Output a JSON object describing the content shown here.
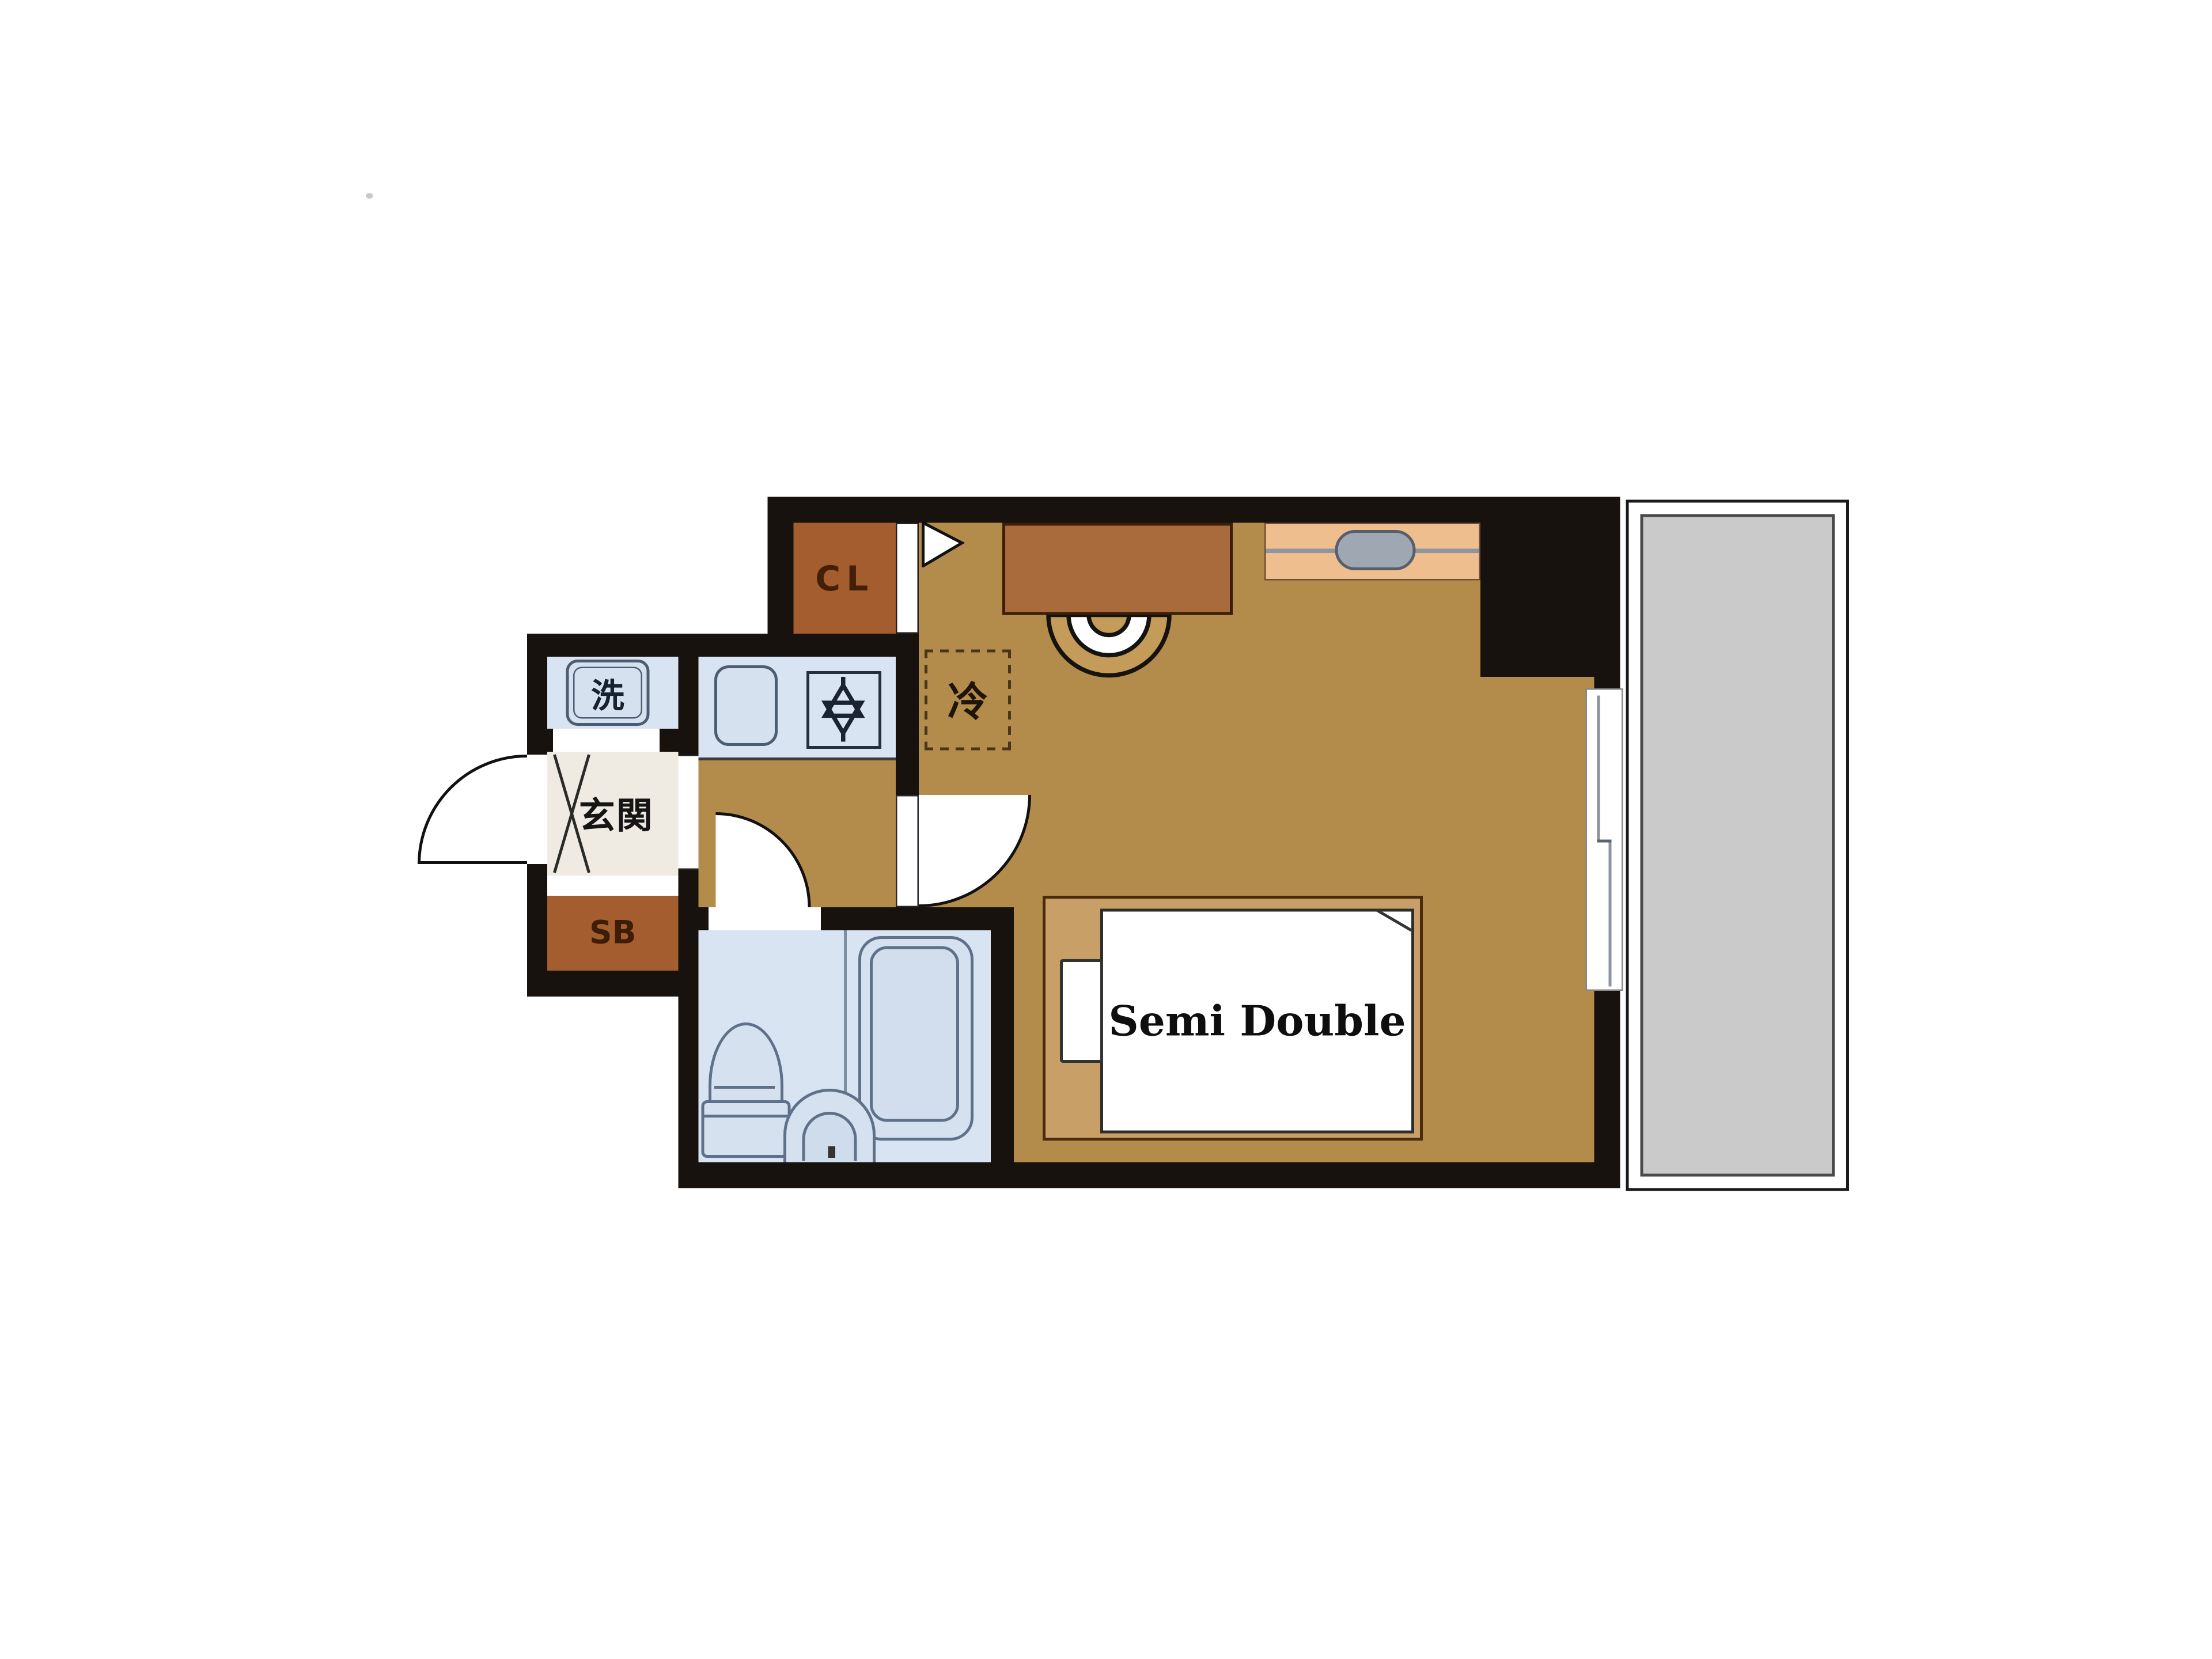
{
  "floorplan": {
    "labels": {
      "closet": "CL",
      "refrigerator": "冷",
      "washing_machine": "洗",
      "entrance": "玄関",
      "shoe_box": "SB",
      "bed": "Semi Double"
    },
    "colors": {
      "wall": "#17120D",
      "room_floor": "#B38C4B",
      "wet_floor": "#D9E4F2",
      "entrance_floor": "#EFEBE2",
      "storage_brown": "#A35D2F",
      "counter_brown": "#A96B3B",
      "bed_frame": "#C79F67",
      "balcony_gray": "#CACACA",
      "window_counter_peach": "#EFBE8F",
      "fixture_fill": "#D5E1EF",
      "fixture_stroke": "#5F7189"
    }
  }
}
